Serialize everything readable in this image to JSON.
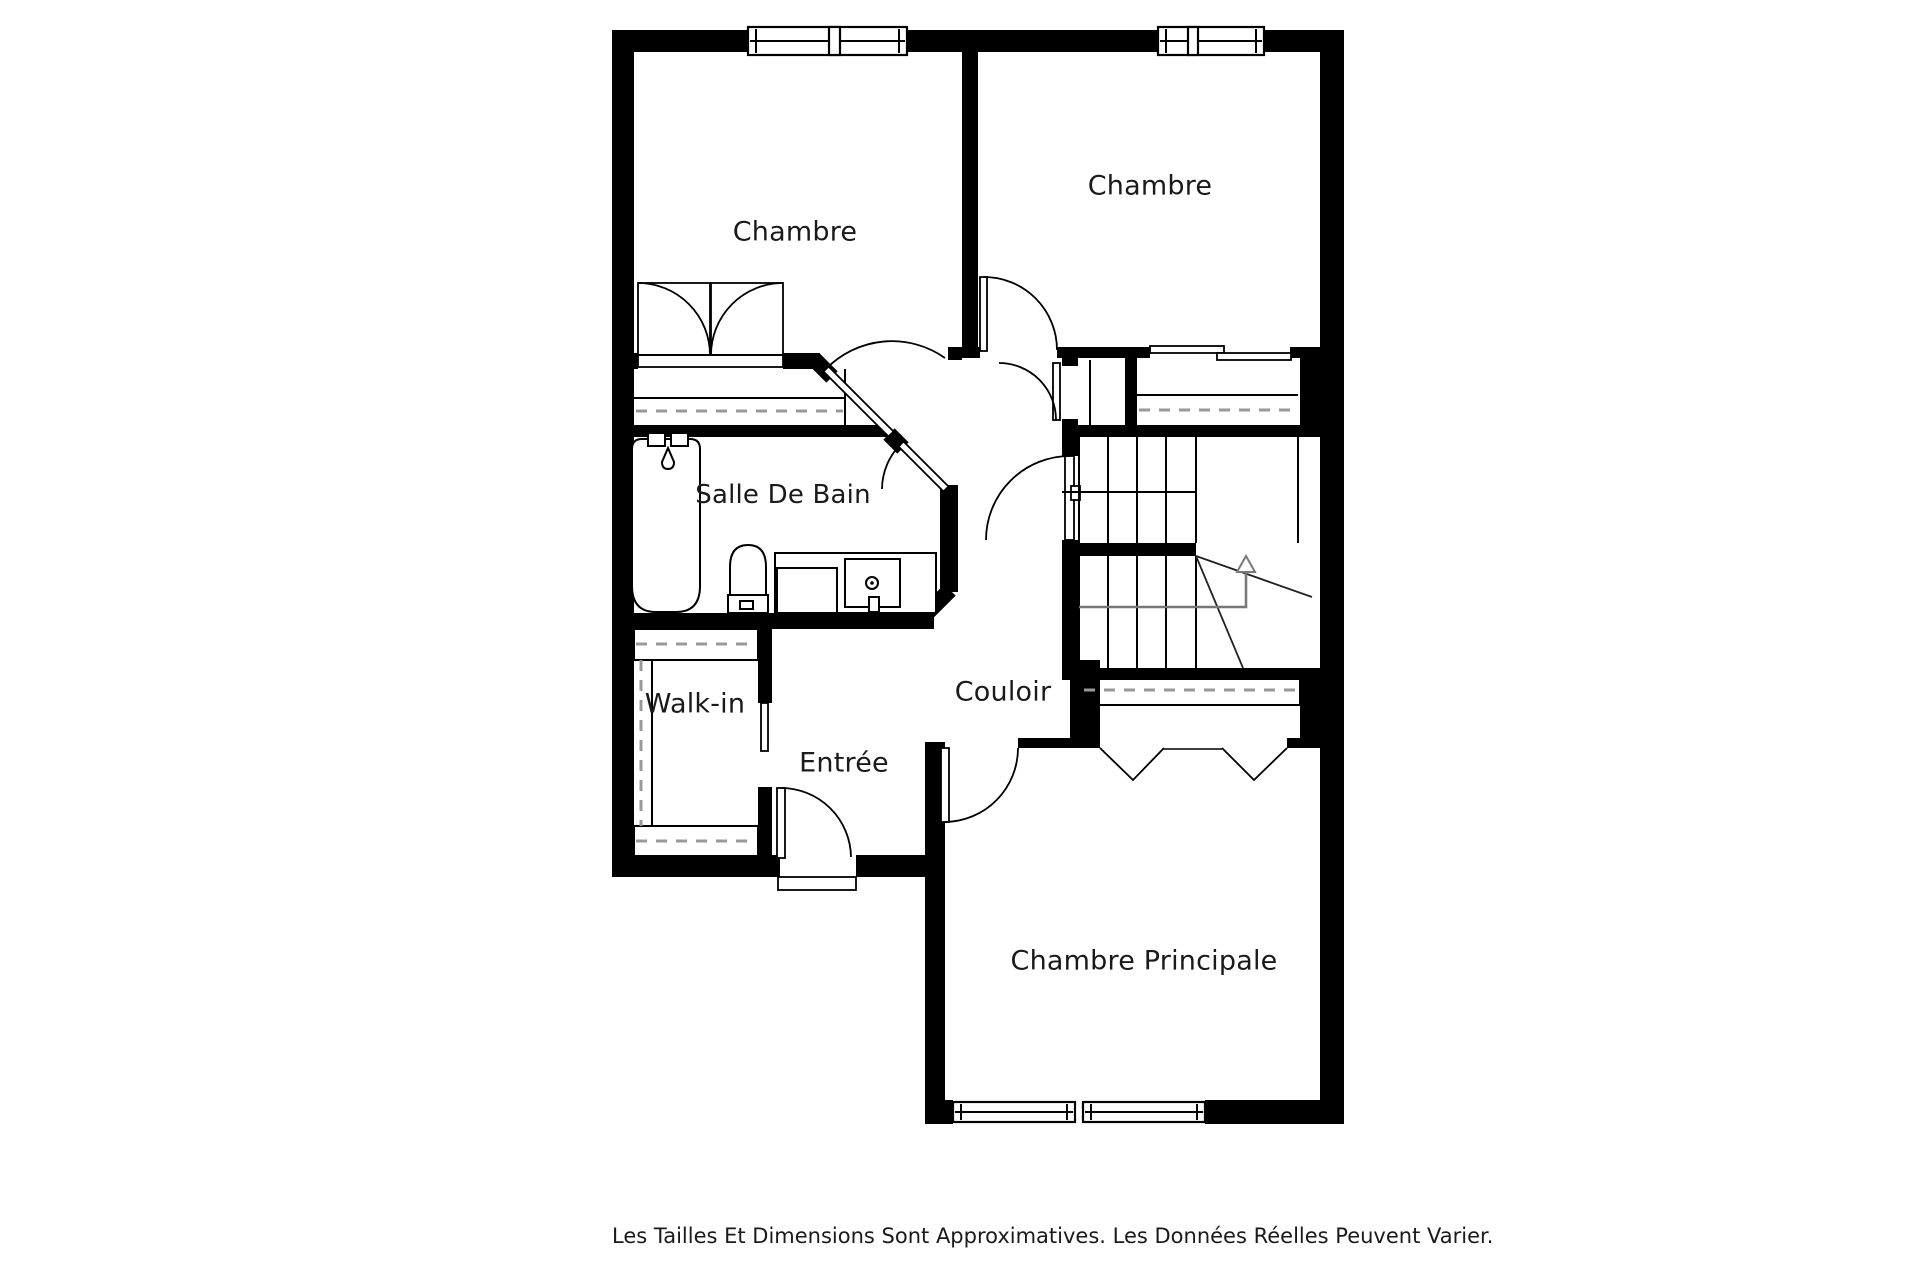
{
  "plan": {
    "type": "floor-plan",
    "language": "fr",
    "rooms": [
      {
        "id": "chambre-1",
        "label": "Chambre"
      },
      {
        "id": "chambre-2",
        "label": "Chambre"
      },
      {
        "id": "salle-de-bain",
        "label": "Salle De Bain"
      },
      {
        "id": "walk-in",
        "label": "Walk-in"
      },
      {
        "id": "couloir",
        "label": "Couloir"
      },
      {
        "id": "entree",
        "label": "Entrée"
      },
      {
        "id": "chambre-principale",
        "label": "Chambre Principale"
      }
    ],
    "features": [
      "stairs-with-up-arrow",
      "bathtub",
      "toilet",
      "vanity-sink",
      "double-closet-doors",
      "bifold-closet-doors",
      "sliding-closet-doors",
      "pocket-door",
      "windows"
    ],
    "colors": {
      "walls": "#000000",
      "background": "#ffffff",
      "label_text": "#1a1a1a",
      "dashed_closet_lines": "#999999",
      "stair_arrow": "#777777"
    }
  },
  "footer": {
    "disclaimer": "Les Tailles Et Dimensions Sont Approximatives. Les Données Réelles Peuvent Varier."
  }
}
